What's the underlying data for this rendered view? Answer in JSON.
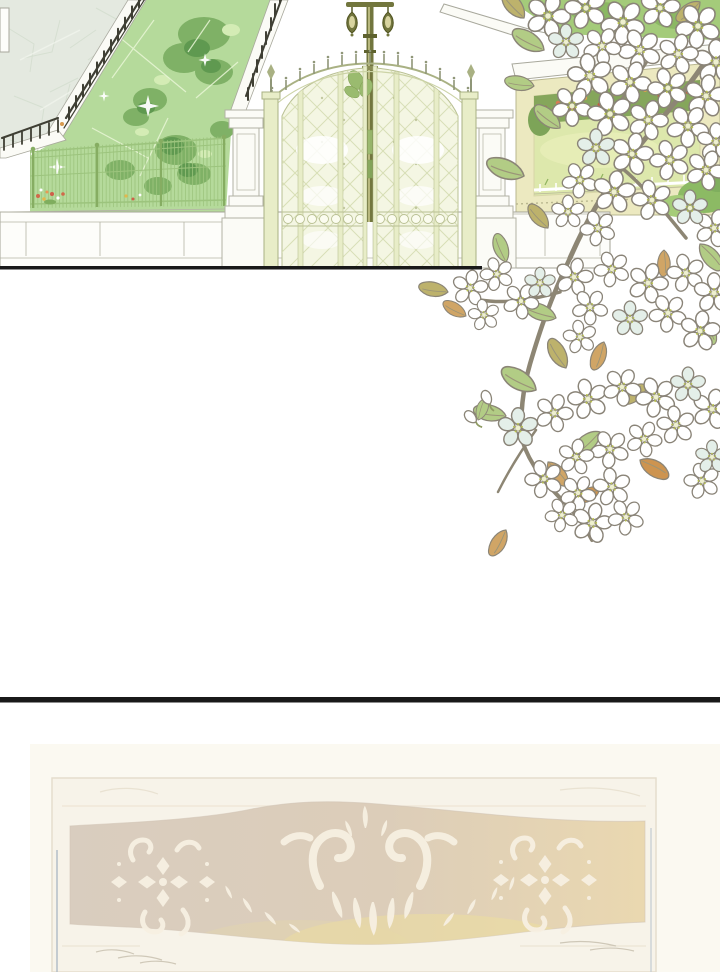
{
  "page": {
    "kind": "webtoon episode page",
    "background": "#ffffff",
    "panels": [
      {
        "name": "estate-entrance",
        "description": "White estate wall with ornate pale-green arched double gate, street lamp above, stone pillars, front lawn with topiary and sparkles, cobblestone path with iron railing at left, pale yellow inner wall with flower garden view at right"
      },
      {
        "name": "blossom-branches",
        "description": "Branches of white five-petal blossoms with green, olive and tan leaves cascading from the top right over both panels"
      },
      {
        "name": "faded-plaque",
        "description": "Very faint ornate carved sign board with scroll ornaments on a beige band, cut off at page bottom"
      }
    ],
    "dividers": [
      {
        "name": "panel1-border-line",
        "y": 266,
        "width": 482
      },
      {
        "name": "page-divider-line",
        "y": 697,
        "width": 720
      }
    ]
  },
  "colors": {
    "panel_border": "#191919",
    "stone_path": "#e4e9e0",
    "lawn": "#b5da9b",
    "bush": "#7fb166",
    "bush_dark": "#5f9950",
    "iron": "#3f3f34",
    "fence_base": "#fbfbf6",
    "mesh_fence": "#9cc47d",
    "gate_frame": "#e8edc8",
    "gate_panel": "#f4f6e3",
    "lattice": "#d6ddb4",
    "gate_outline": "#a9b183",
    "lamp": "#72763e",
    "pillar": "#fbfbf6",
    "wall_yellow": "#ece9c0",
    "hedge": "#a4cb7a",
    "garden_lawn": "#dde8ac",
    "flowerbed": "#85a65b",
    "wall_white": "#fdfdfa",
    "blossom_white": "#ffffff",
    "blossom_blue": "#e4efe9",
    "branch": "#8d8674",
    "leaf_green": "#b2cc85",
    "leaf_olive": "#bdb26c",
    "leaf_tan": "#d0a566",
    "leaf_orange": "#cd9450",
    "plaque_frame": "#f7f3e9",
    "plaque_tint": "#faf7ee",
    "band_left": "#d9cdbf",
    "band_mid": "#dccdb9",
    "band_right": "#ead8b0",
    "band_gold": "#ecdf9f",
    "ornament": "#f7f0e2",
    "plaque_accent": "#b3bec7",
    "scratch": "#cfc8b8"
  }
}
